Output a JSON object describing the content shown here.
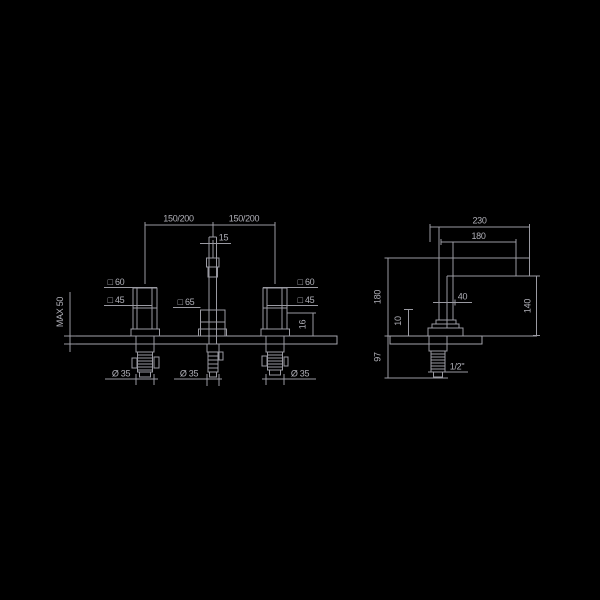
{
  "drawing": {
    "title": "faucet-installation-dimensions",
    "colors": {
      "background": "#000000",
      "line": "#9a9aa2",
      "text": "#b0b0b8"
    },
    "front_view": {
      "dims": {
        "spread_left": "150/200",
        "spread_right": "150/200",
        "spout_width": "15",
        "handle_outer_left": "□ 60",
        "handle_inner_left": "□ 45",
        "spout_body": "□ 65",
        "handle_outer_right": "□ 60",
        "handle_inner_right": "□ 45",
        "handle_base_right": "16",
        "max_counter_thickness": "MAX 50",
        "tail_diameter_left": "Ø 35",
        "tail_diameter_center": "Ø 35",
        "tail_diameter_right": "Ø 35"
      }
    },
    "side_view": {
      "dims": {
        "projection_total": "230",
        "projection_inner": "180",
        "height_above_deck": "180",
        "spout_depth": "40",
        "clearance_height": "140",
        "base_offset": "10",
        "tail_length": "97",
        "connection_size": "1/2\""
      }
    }
  }
}
